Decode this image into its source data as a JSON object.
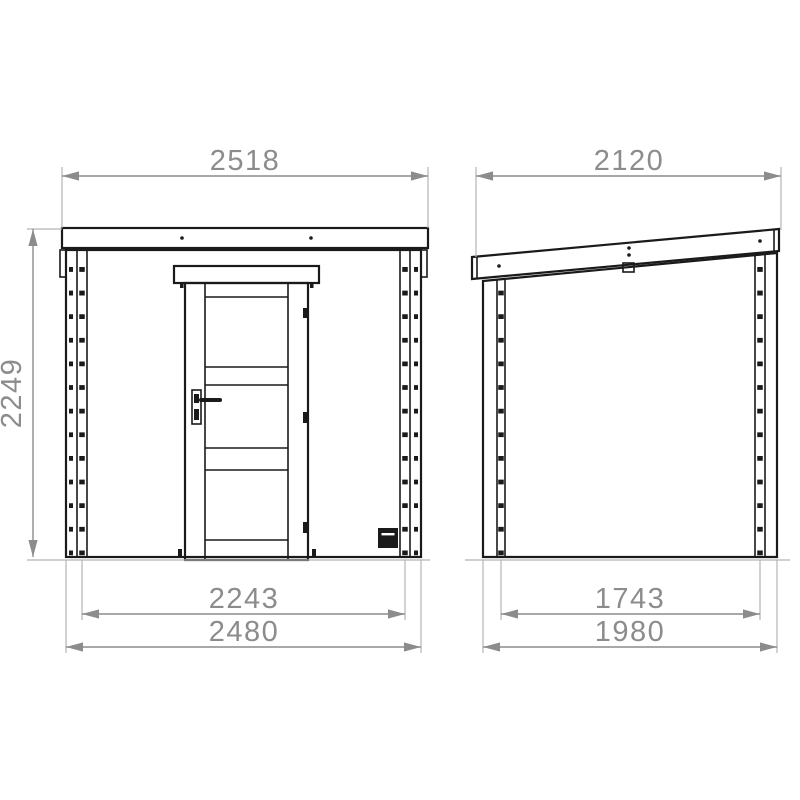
{
  "drawing_type": "shed-elevation-dimensions",
  "dimensions": {
    "front": {
      "roof_width": "2518",
      "height": "2249",
      "inner_width": "2243",
      "base_width": "2480"
    },
    "side": {
      "roof_width": "2120",
      "inner_width": "1743",
      "base_width": "1980"
    }
  },
  "colors": {
    "linework": "#1a1a1a",
    "dimension": "#8c8c8c",
    "background": "#ffffff"
  },
  "icons": {
    "door_handle": "lever-handle-with-keyhole",
    "hinges": "door-hinge-marks",
    "vent": "wall-vent-square",
    "screws": "roof-screw-dots"
  }
}
